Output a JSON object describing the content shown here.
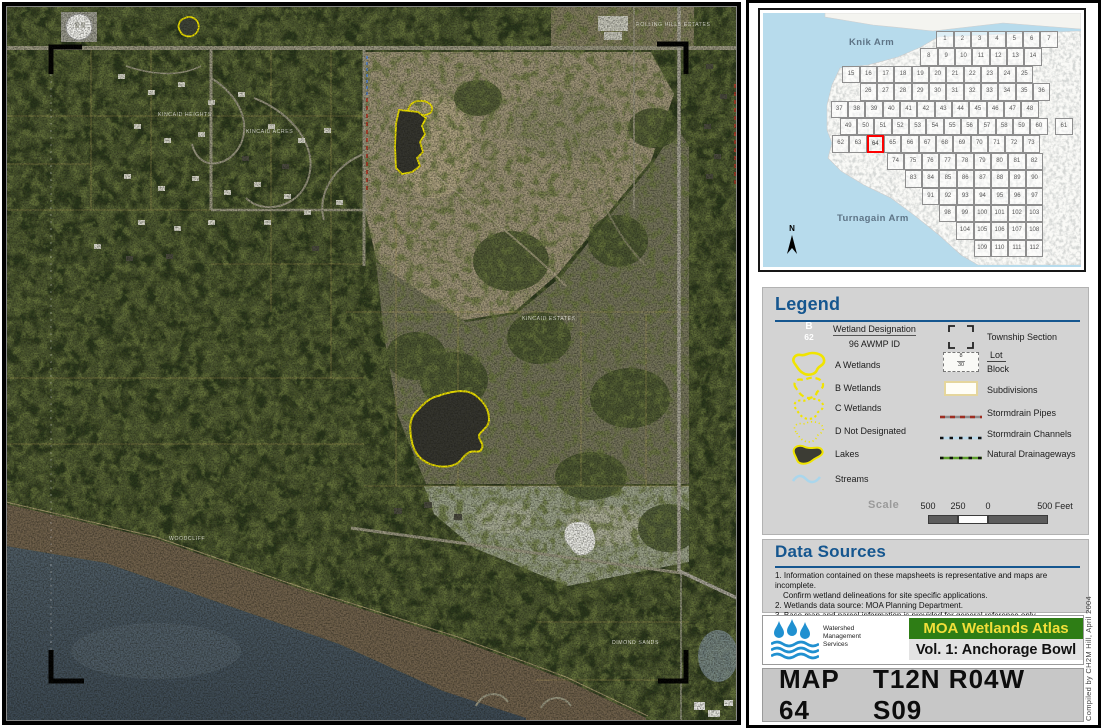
{
  "index_map": {
    "water_label_north": "Knik Arm",
    "water_label_south": "Turnagain Arm",
    "north_label": "N",
    "highlight_cell": 64,
    "highlight_color": "#fe0000",
    "water_color": "#b7dbec",
    "rows": [
      {
        "first": 1,
        "count": 7,
        "start_col": 6.1
      },
      {
        "first": 8,
        "count": 7,
        "start_col": 5.17
      },
      {
        "first": 15,
        "count": 11,
        "start_col": 0.68
      },
      {
        "first": 26,
        "count": 11,
        "start_col": 1.67
      },
      {
        "first": 37,
        "count": 12,
        "start_col": 0.0
      },
      {
        "first": 49,
        "count": 12,
        "start_col": 0.52
      },
      {
        "first": 62,
        "count": 12,
        "start_col": 0.08
      },
      {
        "first": 74,
        "count": 9,
        "start_col": 3.25
      },
      {
        "first": 83,
        "count": 8,
        "start_col": 4.27
      },
      {
        "first": 91,
        "count": 7,
        "start_col": 5.27
      },
      {
        "first": 98,
        "count": 6,
        "start_col": 6.25
      },
      {
        "first": 104,
        "count": 5,
        "start_col": 7.25
      },
      {
        "first": 109,
        "count": 4,
        "start_col": 8.25
      }
    ],
    "extra_cells": [
      {
        "number": 61,
        "row": 5,
        "col": 12.96
      }
    ]
  },
  "legend": {
    "title": "Legend",
    "heading_color": "#15568f",
    "wetland_designation": {
      "symbol_top": "B",
      "symbol_bottom": "62",
      "label_line1": "Wetland Designation",
      "label_line2": "96 AWMP ID"
    },
    "items_left": [
      {
        "label": "A Wetlands"
      },
      {
        "label": "B Wetlands"
      },
      {
        "label": "C Wetlands"
      },
      {
        "label": "D Not Designated"
      },
      {
        "label": "Lakes"
      },
      {
        "label": "Streams"
      }
    ],
    "items_right": [
      {
        "label": "Township Section"
      },
      {
        "label_top": "Lot",
        "label_bottom": "Block",
        "symbol_top": "8",
        "symbol_bottom": "30"
      },
      {
        "label": "Subdivisions"
      },
      {
        "label": "Stormdrain Pipes"
      },
      {
        "label": "Stormdrain Channels"
      },
      {
        "label": "Natural Drainageways"
      }
    ],
    "scale": {
      "label": "Scale",
      "tick1": "500",
      "tick2": "250",
      "tick3": "0",
      "right_label": "500 Feet"
    },
    "wetland_yellow": "#f0e400"
  },
  "data_sources": {
    "title": "Data Sources",
    "lines": [
      "1. Information contained on these mapsheets is representative and maps are incomplete.",
      "Confirm wetland delineations for site specific applications.",
      "2. Wetlands data source: MOA Planning Department.",
      "3. Base map and parcel information is provided for general reference only.",
      "4. Base Imagery: 2001 IKONOS satellite imagery."
    ]
  },
  "footer": {
    "logo_line1": "Watershed",
    "logo_line2": "Management",
    "logo_line3": "Services",
    "atlas_title": "MOA Wetlands Atlas",
    "atlas_title_bg": "#2e7d15",
    "atlas_title_color": "#f2df3a",
    "atlas_subtitle": "Vol. 1:  Anchorage Bowl",
    "map_number": "MAP 64",
    "township_range_section": "T12N R04W S09",
    "compiled_by": "Compiled by CH2M Hill, April 2004"
  },
  "aerial": {
    "labels": [
      {
        "text": "ROLLING HILLS ESTATES",
        "x": 630,
        "y": 20
      },
      {
        "text": "KINCAID HEIGHTS",
        "x": 152,
        "y": 110
      },
      {
        "text": "KINCAID ACRES",
        "x": 240,
        "y": 127
      },
      {
        "text": "KINCAID ESTATES",
        "x": 516,
        "y": 314
      },
      {
        "text": "WOODCLIFF",
        "x": 163,
        "y": 534
      },
      {
        "text": "DIMOND SANDS",
        "x": 606,
        "y": 638
      }
    ]
  }
}
